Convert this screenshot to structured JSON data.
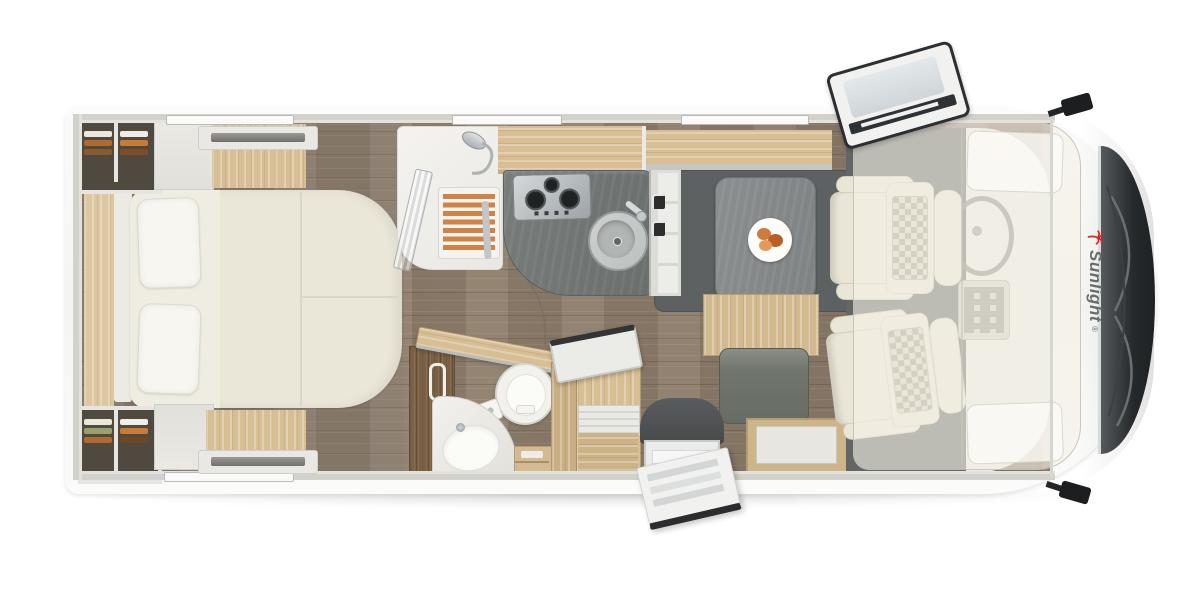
{
  "brand": {
    "logo_text": "Sunlight",
    "registered_mark": "®",
    "logo_text_color": "#6b6b6d",
    "palm_icon_color": "#d2232a"
  },
  "vehicle": {
    "view": "top-down-floor-plan",
    "front_direction": "right",
    "rear_direction": "left"
  },
  "palette": {
    "background": "#ffffff",
    "body_shell": "#f7f7f5",
    "wall_band": "#d2d2cd",
    "light_wood": "#d7be94",
    "dark_wood": "#7a6144",
    "floor_wood": "#8d7c6a",
    "counter_gray": "#6f7473",
    "mat_gray": "#5d6161",
    "upholstery_cream": "#ebe7d8",
    "glass_dark": "#2b2e30",
    "chrome": "#c3c7c9",
    "clothes_orange": "#b06a2e"
  },
  "rooms": {
    "bedroom": {
      "label": "rear-bedroom",
      "features": [
        "island-bed",
        "pillow-left",
        "pillow-right",
        "wardrobe-top-left",
        "wardrobe-bottom-left",
        "bedside-cabinet-top",
        "bedside-cabinet-bottom",
        "wood-deck-strip",
        "roof-vent-top",
        "roof-vent-bottom"
      ]
    },
    "shower": {
      "label": "shower-cabin",
      "features": [
        "teak-slat-mat",
        "glass-folding-door",
        "shower-head"
      ]
    },
    "kitchen": {
      "label": "kitchenette",
      "features": [
        "overhead-cabinet",
        "l-shaped-counter",
        "three-burner-hob",
        "round-sink",
        "faucet",
        "fridge-tower"
      ]
    },
    "bathroom": {
      "label": "washroom",
      "features": [
        "open-wood-door",
        "round-toilet",
        "corner-washbasin",
        "faucet",
        "dark-wood-cabinet",
        "towel-handle",
        "shelf-unit"
      ]
    },
    "dinette": {
      "label": "dinette",
      "features": [
        "overhead-cabinet",
        "table",
        "plate-with-food",
        "bench-seat",
        "sideboard"
      ]
    },
    "entrance": {
      "label": "entry",
      "features": [
        "step-well",
        "entry-step",
        "open-entry-door",
        "storage-chest-with-open-lid"
      ]
    },
    "cab": {
      "label": "driver-cab",
      "features": [
        "driver-swivel-seat",
        "passenger-swivel-seat",
        "steering-wheel",
        "center-console",
        "dashboard",
        "drop-down-bed-overlay",
        "bed-pillow-top",
        "bed-pillow-bottom"
      ]
    }
  },
  "exterior": {
    "features": [
      "windshield-with-wipers",
      "side-mirror-top",
      "side-mirror-bottom",
      "open-roof-skylight",
      "window-slot-top-1",
      "window-slot-top-2",
      "window-slot-top-3",
      "window-slot-bottom-1",
      "ground-shadow"
    ]
  }
}
